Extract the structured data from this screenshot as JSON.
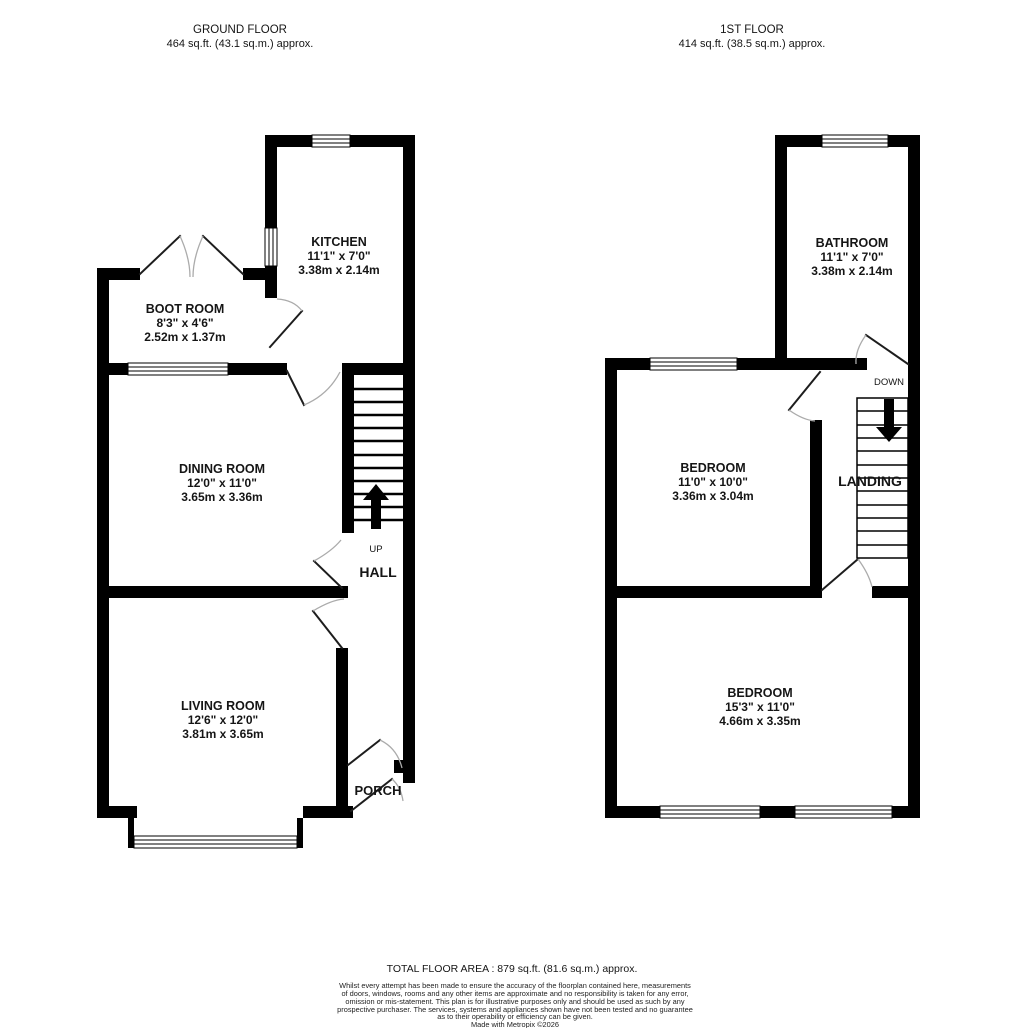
{
  "ground_floor": {
    "title": "GROUND FLOOR",
    "area": "464 sq.ft. (43.1 sq.m.) approx.",
    "stairs_label": "UP",
    "rooms": {
      "kitchen": {
        "name": "KITCHEN",
        "imperial": "11'1\"  x 7'0\"",
        "metric": "3.38m  x 2.14m"
      },
      "boot_room": {
        "name": "BOOT ROOM",
        "imperial": "8'3\"  x 4'6\"",
        "metric": "2.52m  x 1.37m"
      },
      "dining_room": {
        "name": "DINING ROOM",
        "imperial": "12'0\"  x 11'0\"",
        "metric": "3.65m  x 3.36m"
      },
      "living_room": {
        "name": "LIVING ROOM",
        "imperial": "12'6\"  x 12'0\"",
        "metric": "3.81m  x 3.65m"
      },
      "hall": {
        "name": "HALL"
      },
      "porch": {
        "name": "PORCH"
      }
    }
  },
  "first_floor": {
    "title": "1ST FLOOR",
    "area": "414 sq.ft. (38.5 sq.m.) approx.",
    "stairs_label": "DOWN",
    "rooms": {
      "bathroom": {
        "name": "BATHROOM",
        "imperial": "11'1\"  x 7'0\"",
        "metric": "3.38m  x 2.14m"
      },
      "bedroom_front": {
        "name": "BEDROOM",
        "imperial": "11'0\"  x 10'0\"",
        "metric": "3.36m  x 3.04m"
      },
      "bedroom_rear": {
        "name": "BEDROOM",
        "imperial": "15'3\"  x 11'0\"",
        "metric": "4.66m  x 3.35m"
      },
      "landing": {
        "name": "LANDING"
      }
    }
  },
  "footer": {
    "total": "TOTAL FLOOR AREA : 879 sq.ft. (81.6 sq.m.) approx.",
    "disclaimer_lines": [
      "Whilst every attempt has been made to ensure the accuracy of the floorplan contained here, measurements",
      "of doors, windows, rooms and any other items are approximate and no responsibility is taken for any error,",
      "omission or mis-statement. This plan is for illustrative purposes only and should be used as such by any",
      "prospective purchaser. The services, systems and appliances shown have not been tested and no guarantee",
      "as to their operability or efficiency can be given.",
      "Made with Metropix ©2026"
    ]
  },
  "colors": {
    "wall": "#000000",
    "background": "#ffffff"
  }
}
